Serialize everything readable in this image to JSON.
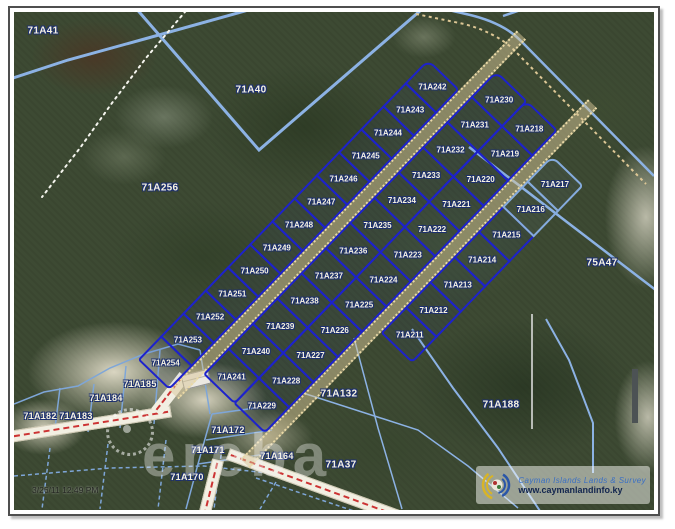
{
  "map_viewer": {
    "watermark_brand": "ereba",
    "timestamp": "3/26/11 12:49 PM",
    "logo": {
      "org_line": "Cayman Islands Lands & Survey",
      "url_line": "www.caymanlandinfo.ky"
    },
    "colors": {
      "parcel_bold_blue": "#1d22cc",
      "parcel_light_blue": "#85abdd",
      "label_fill": "#f6f3e2",
      "label_outline": "#1c2f70",
      "road_sand": "#d8c698",
      "road_centerline_red": "#cc3333",
      "forest_base": "#3d4a33"
    },
    "subdivision": {
      "rows": [
        {
          "name": "row1",
          "parcels": [
            "71A254",
            "71A253",
            "71A252",
            "71A251",
            "71A250",
            "71A249",
            "71A248",
            "71A247",
            "71A246",
            "71A245",
            "71A244",
            "71A243",
            "71A242"
          ]
        },
        {
          "name": "row2",
          "parcels": [
            "71A241",
            "71A240",
            "71A239",
            "71A238",
            "71A237",
            "71A236",
            "71A235",
            "71A234",
            "71A233",
            "71A232",
            "71A231",
            "71A230"
          ]
        },
        {
          "name": "row3",
          "parcels": [
            "71A229",
            "71A228",
            "71A227",
            "71A226",
            "71A225",
            "71A224",
            "71A223",
            "71A222",
            "71A221",
            "71A220",
            "71A219",
            "71A218"
          ]
        },
        {
          "name": "row4",
          "parcels": [
            "71A211",
            "71A212",
            "71A213",
            "71A214",
            "71A215",
            "71A216",
            "71A217"
          ]
        }
      ],
      "light_parcels": [
        "71A216",
        "71A217"
      ]
    },
    "outer_parcels": [
      {
        "label": "71A41",
        "x": 29,
        "y": 19
      },
      {
        "label": "71A40",
        "x": 237,
        "y": 78
      },
      {
        "label": "71A256",
        "x": 146,
        "y": 176
      },
      {
        "label": "75A47",
        "x": 588,
        "y": 251
      },
      {
        "label": "71A188",
        "x": 487,
        "y": 393
      },
      {
        "label": "71A37",
        "x": 327,
        "y": 453
      },
      {
        "label": "71A132",
        "x": 325,
        "y": 382
      },
      {
        "label": "71A185",
        "x": 126,
        "y": 372
      },
      {
        "label": "71A184",
        "x": 92,
        "y": 386
      },
      {
        "label": "71A183",
        "x": 62,
        "y": 404
      },
      {
        "label": "71A182",
        "x": 26,
        "y": 404
      },
      {
        "label": "71A172",
        "x": 214,
        "y": 418
      },
      {
        "label": "71A171",
        "x": 194,
        "y": 438
      },
      {
        "label": "71A170",
        "x": 173,
        "y": 465
      },
      {
        "label": "71A164",
        "x": 263,
        "y": 444
      }
    ]
  }
}
